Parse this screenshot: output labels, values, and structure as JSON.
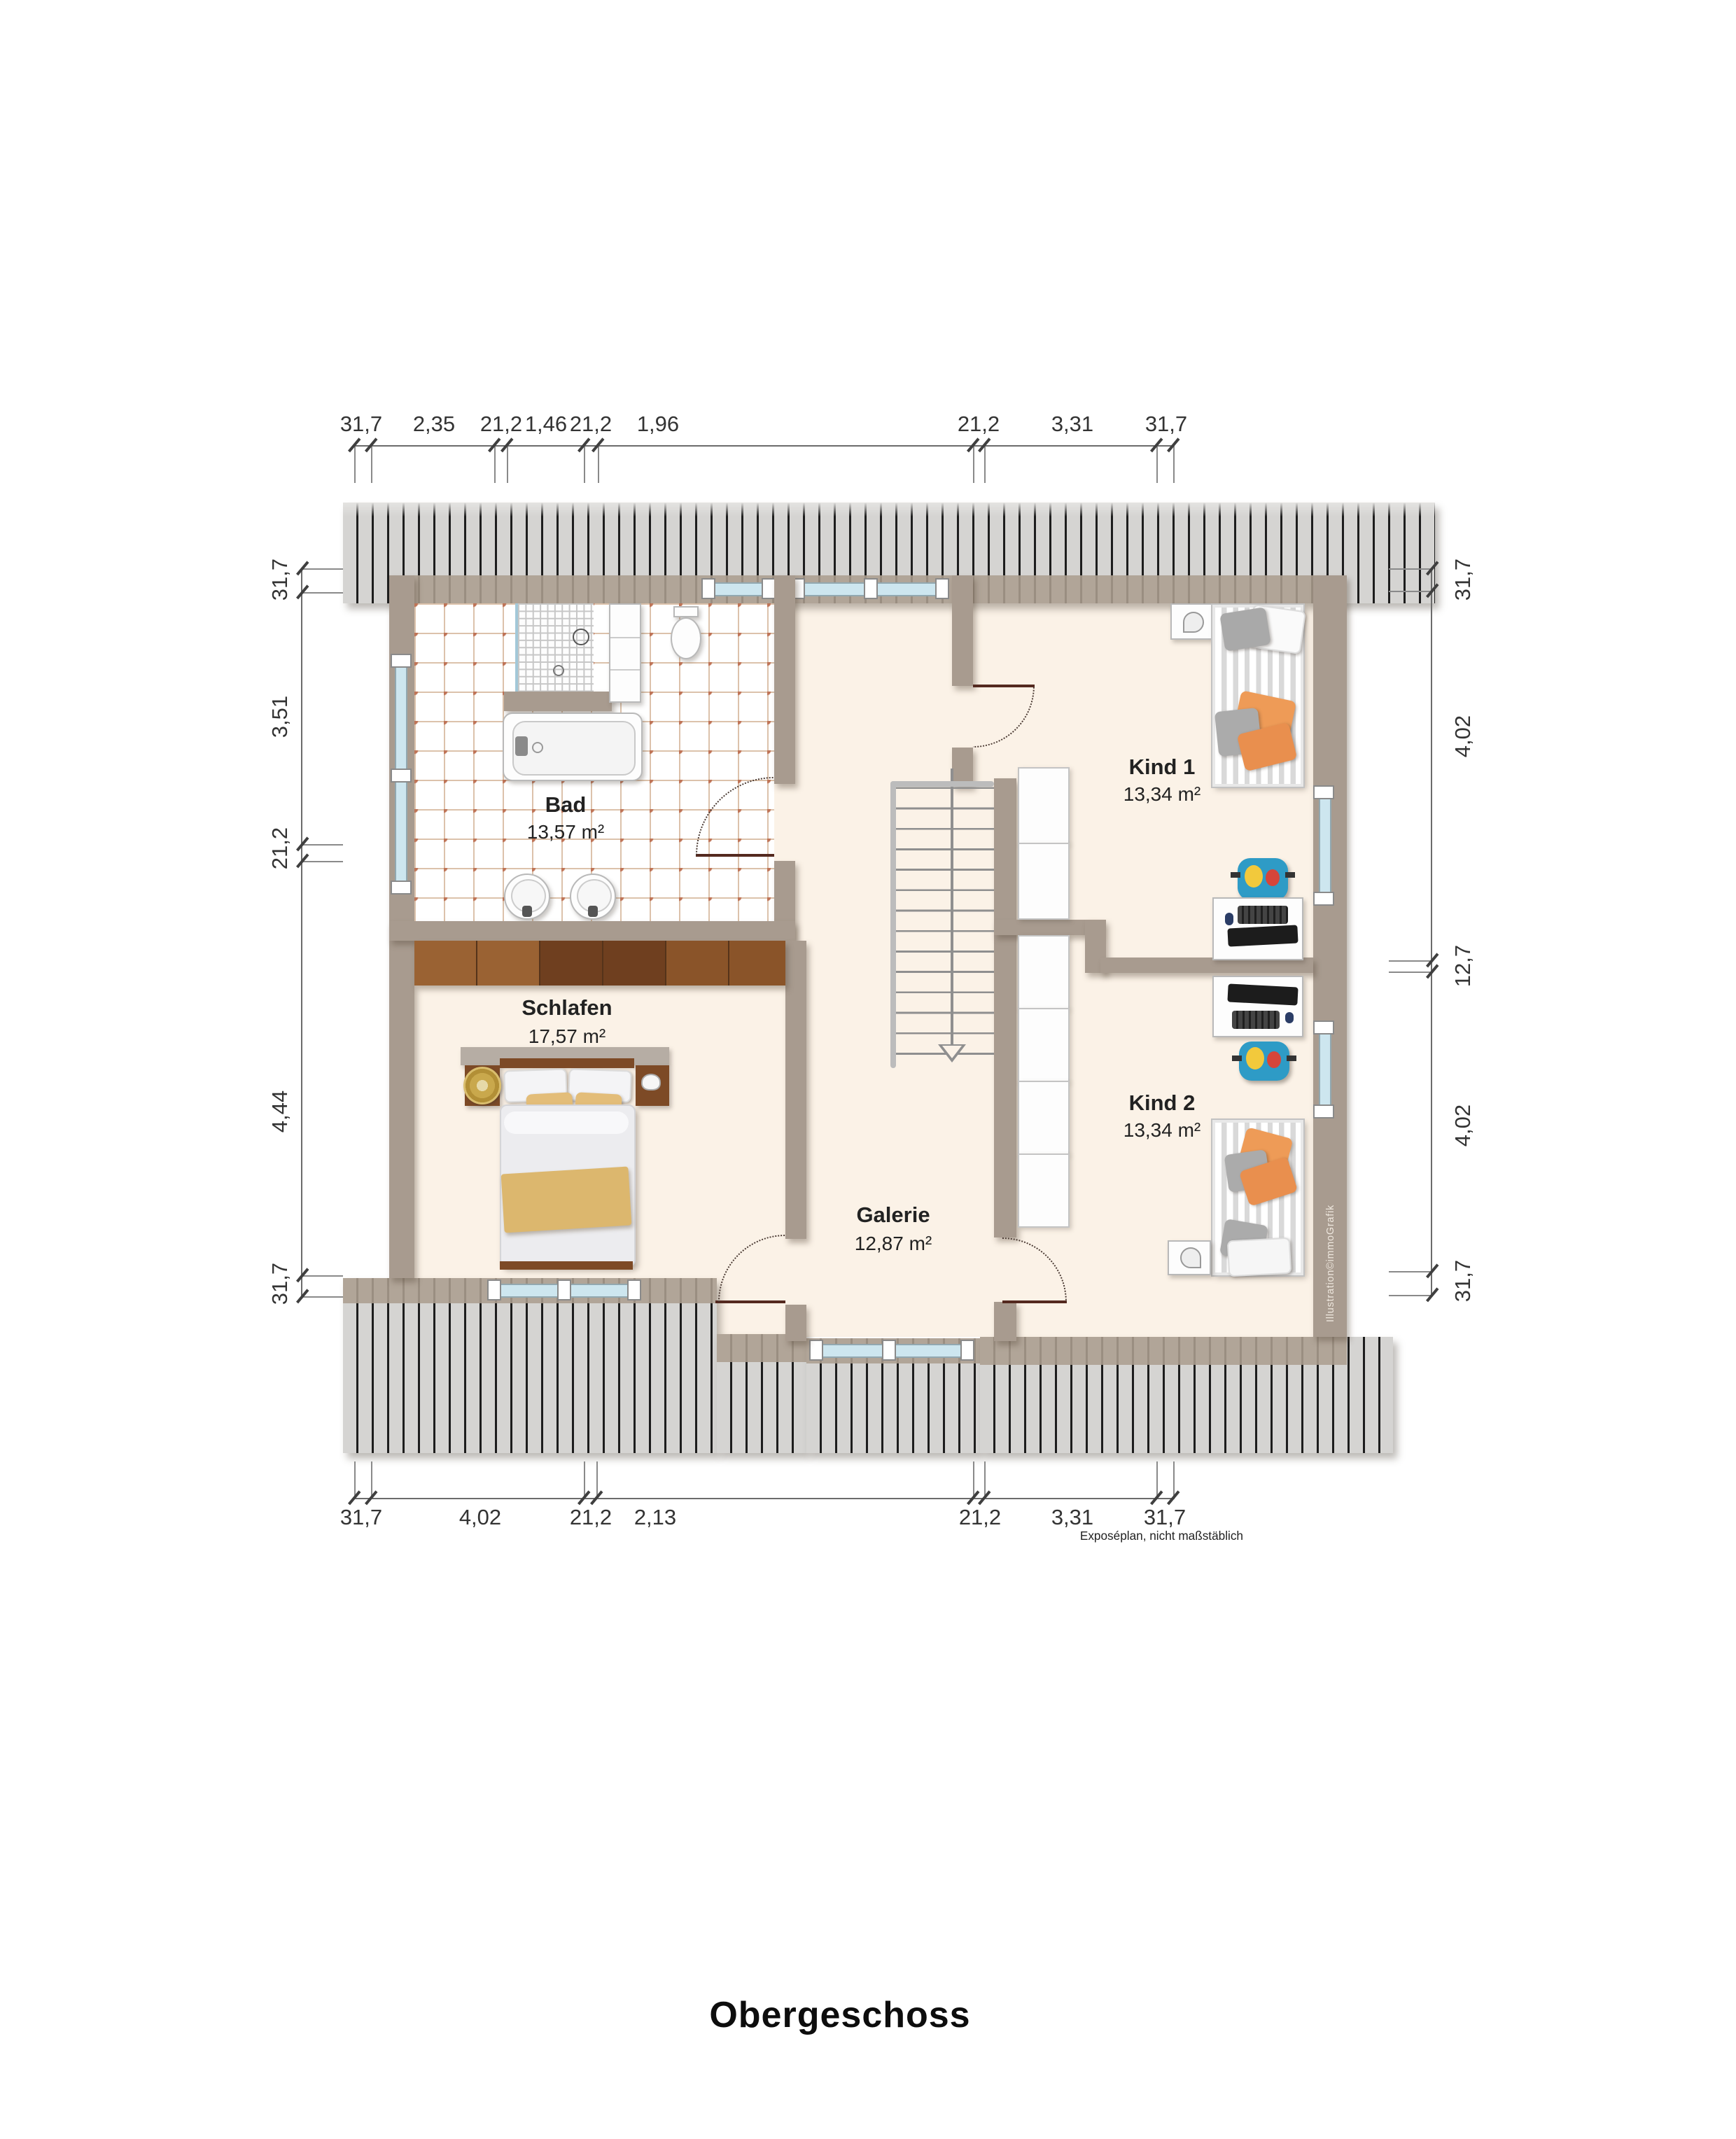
{
  "title": "Obergeschoss",
  "disclaimer": "Exposéplan, nicht maßstäblich",
  "credit": "Illustration©immoGrafik",
  "rooms": {
    "bad": {
      "name": "Bad",
      "area": "13,57 m²"
    },
    "schlafen": {
      "name": "Schlafen",
      "area": "17,57 m²"
    },
    "kind1": {
      "name": "Kind 1",
      "area": "13,34 m²"
    },
    "kind2": {
      "name": "Kind 2",
      "area": "13,34 m²"
    },
    "galerie": {
      "name": "Galerie",
      "area": "12,87 m²"
    }
  },
  "dims": {
    "top": [
      "31,7",
      "2,35",
      "21,2",
      "1,46",
      "21,2",
      "1,96",
      "21,2",
      "3,31",
      "31,7"
    ],
    "bottom": [
      "31,7",
      "4,02",
      "21,2",
      "2,13",
      "21,2",
      "3,31",
      "31,7"
    ],
    "left": [
      "31,7",
      "3,51",
      "21,2",
      "4,44",
      "31,7"
    ],
    "right": [
      "31,7",
      "4,02",
      "12,7",
      "4,02",
      "31,7"
    ]
  },
  "colors": {
    "wall": "#a89b8f",
    "floor_cream": "#fbf2e7",
    "roof_gray": "#d5d4d2",
    "tile_accent": "#bf7457",
    "window_blue": "#cde6ef",
    "door_leaf": "#54291f",
    "wood_brown": "#7d4a26",
    "accent_orange": "#ee9b57",
    "accent_tan": "#e3bd79"
  }
}
